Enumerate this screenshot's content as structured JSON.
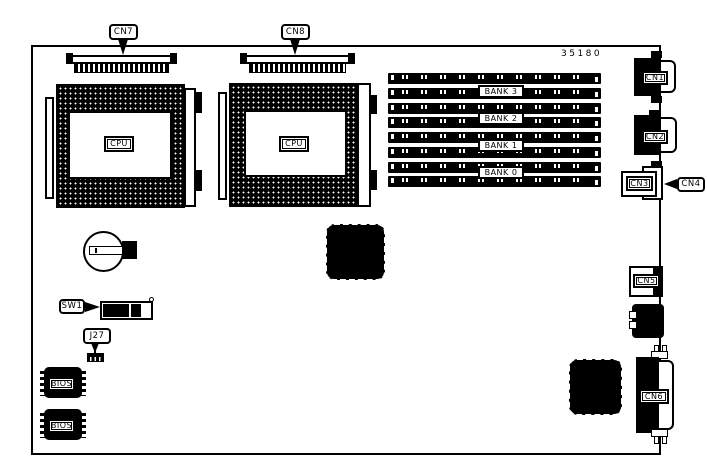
{
  "page": {
    "background": "#ffffff",
    "ink": "#000000"
  },
  "board": {
    "part_number": "35180",
    "callouts": {
      "cn7": {
        "label": "CN7"
      },
      "cn8": {
        "label": "CN8"
      },
      "cn4": {
        "label": "CN4"
      },
      "sw1": {
        "label": "SW1"
      },
      "j27": {
        "label": "J27"
      }
    },
    "ports": {
      "cn1": {
        "label": "CN1"
      },
      "cn2": {
        "label": "CN2"
      },
      "cn3": {
        "label": "CN3"
      },
      "cn5": {
        "label": "CN5"
      },
      "cn6": {
        "label": "CN6"
      }
    },
    "cpu_sockets": [
      {
        "label": "CPU"
      },
      {
        "label": "CPU"
      }
    ],
    "memory": {
      "slot_count": 8,
      "banks": [
        {
          "label": "BANK 3"
        },
        {
          "label": "BANK 2"
        },
        {
          "label": "BANK 1"
        },
        {
          "label": "BANK 0"
        }
      ]
    },
    "chips": {
      "bios1": {
        "label": "BIOS"
      },
      "bios2": {
        "label": "BIOS"
      }
    }
  }
}
